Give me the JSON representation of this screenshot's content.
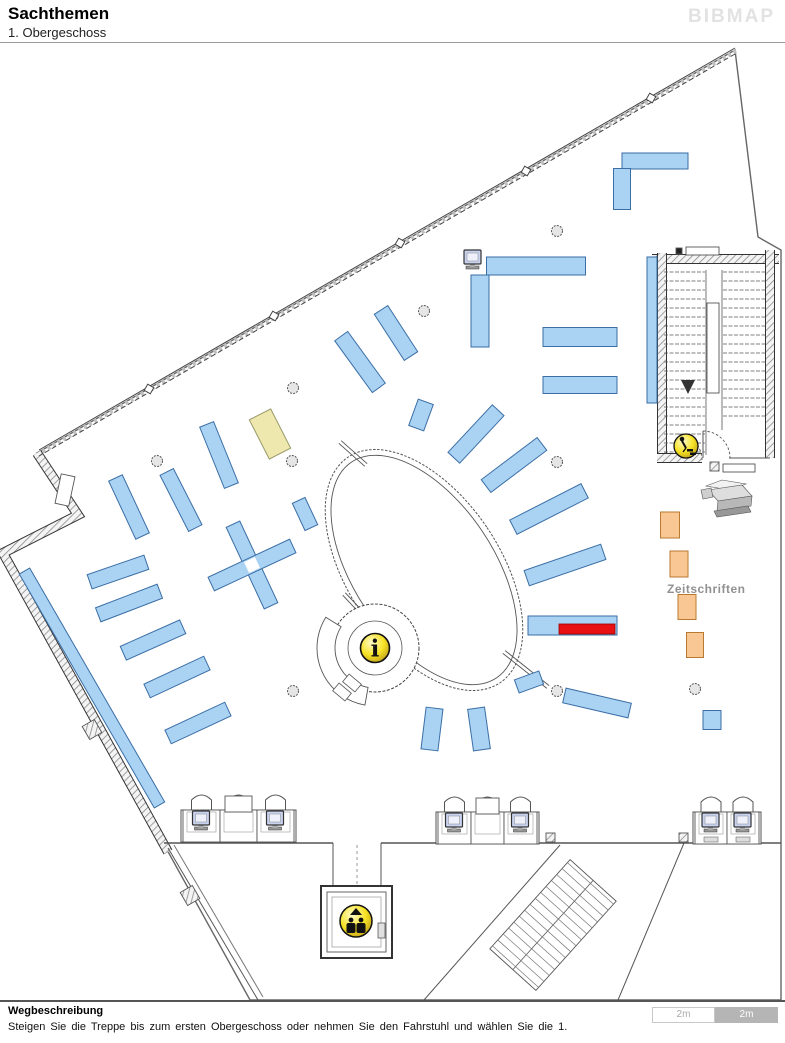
{
  "header": {
    "title": "Sachthemen",
    "subtitle": "1. Obergeschoss",
    "logo": "BIBMAP"
  },
  "footer": {
    "heading": "Wegbeschreibung",
    "text": "Steigen Sie die Treppe bis zum ersten Obergeschoss oder nehmen Sie den Fahrstuhl und wählen Sie die 1.",
    "scale_left": "2m",
    "scale_right": "2m"
  },
  "map": {
    "colors": {
      "shelf_fill": "#a9d2f3",
      "shelf_stroke": "#3a6ea5",
      "yellow_fill": "#eee8ae",
      "yellow_stroke": "#99996a",
      "orange_fill": "#f9c793",
      "orange_stroke": "#b97931",
      "red_fill": "#e81010",
      "red_stroke": "#990000",
      "wall": "#555",
      "column_fill": "#e6e6e6",
      "monitor_fill": "#c9d2ef"
    },
    "labels": [
      {
        "text": "Zeitschriften",
        "x": 667,
        "y": 593,
        "size": 12,
        "color": "#919191"
      }
    ],
    "outline": [
      [
        735,
        50
      ],
      [
        37,
        453
      ],
      [
        78,
        515
      ],
      [
        3,
        553
      ],
      [
        250,
        1000
      ],
      [
        781,
        1000
      ],
      [
        781,
        250
      ],
      [
        758,
        237
      ]
    ],
    "hatch_walls": [
      [
        [
          37,
          453
        ],
        [
          78,
          515
        ],
        [
          3,
          553
        ],
        [
          168,
          852
        ]
      ],
      [
        [
          652,
          259
        ],
        [
          779,
          259
        ]
      ],
      [
        [
          662,
          253
        ],
        [
          662,
          462
        ]
      ],
      [
        [
          770,
          250
        ],
        [
          770,
          458
        ]
      ],
      [
        [
          657,
          458
        ],
        [
          702,
          458
        ]
      ]
    ],
    "nw_wall": {
      "a": [
        735,
        48
      ],
      "b": [
        39,
        450
      ],
      "ticks": [
        [
          651,
          98
        ],
        [
          526,
          171
        ],
        [
          400,
          243
        ],
        [
          274,
          316
        ],
        [
          149,
          389
        ]
      ]
    },
    "lines": [
      [
        164,
        843,
        333,
        843,
        1.5,
        "#555",
        ""
      ],
      [
        381,
        843,
        781,
        843,
        1.5,
        "#555",
        ""
      ],
      [
        333,
        843,
        333,
        887,
        1,
        "#555",
        ""
      ],
      [
        381,
        843,
        381,
        887,
        1,
        "#555",
        ""
      ],
      [
        357,
        845,
        357,
        885,
        1,
        "#999",
        "3 3"
      ],
      [
        560,
        845,
        424,
        1000,
        1,
        "#555",
        ""
      ],
      [
        684,
        843,
        618,
        1000,
        1,
        "#555",
        ""
      ],
      [
        168,
        848,
        258,
        1000,
        1,
        "#555",
        ""
      ],
      [
        174,
        845,
        263,
        997,
        1,
        "#777",
        ""
      ],
      [
        706,
        270,
        706,
        455,
        0.8,
        "#555",
        ""
      ],
      [
        722,
        270,
        722,
        430,
        0.8,
        "#555",
        ""
      ],
      [
        729,
        458,
        770,
        458,
        1,
        "#555",
        ""
      ],
      [
        703,
        431,
        703,
        458,
        1,
        "#555",
        ""
      ]
    ],
    "rects": [
      [
        686,
        247,
        33,
        8,
        "#fff",
        0
      ],
      [
        676,
        248,
        6,
        6,
        "#222",
        0
      ],
      [
        723,
        464,
        32,
        8,
        "#fff",
        0
      ],
      [
        707,
        303,
        12,
        90,
        "#fff",
        0
      ],
      [
        58,
        475,
        14,
        30,
        "#fff",
        12
      ],
      [
        183,
        888,
        14,
        15,
        "hatch",
        -30
      ],
      [
        85,
        722,
        14,
        15,
        "hatch",
        -30
      ],
      [
        710,
        462,
        9,
        9,
        "hatch",
        0
      ],
      [
        284,
        833,
        9,
        9,
        "hatch",
        0
      ],
      [
        546,
        833,
        9,
        9,
        "hatch",
        0
      ],
      [
        679,
        833,
        9,
        9,
        "hatch",
        0
      ]
    ],
    "stair_treads": {
      "left": {
        "x1": 664,
        "x2": 705,
        "y0": 272,
        "y1": 452
      },
      "right": {
        "x1": 723,
        "x2": 765,
        "y0": 272,
        "y1": 420
      },
      "step": 9
    },
    "stair_arrow": [
      [
        681,
        380
      ],
      [
        695,
        380
      ],
      [
        688,
        394
      ]
    ],
    "door_arcs": [
      {
        "path": "M 703,431 A 27 27 0 0 1 730,458"
      },
      {
        "path": "M 702,460 A 26 26 0 0 0 676,434"
      }
    ],
    "diag_stairs": {
      "cx": 553,
      "cy": 925,
      "w": 120,
      "h": 62,
      "r": -48,
      "treads": 15
    },
    "ellipse": {
      "cx": 424,
      "cy": 570,
      "rx": 76,
      "ry": 136,
      "rot": -34
    },
    "connectors": [
      [
        340,
        442,
        366,
        465
      ],
      [
        344,
        594,
        360,
        611
      ],
      [
        504,
        652,
        548,
        687
      ]
    ],
    "info_desk": {
      "cx": 375,
      "cy": 648,
      "r_outer": 44,
      "r_inner": 27,
      "crescent": {
        "r1": 40,
        "r2": 58,
        "a1": 100,
        "a2": 212
      },
      "rects": [
        [
          352,
          683,
          16,
          10,
          40
        ],
        [
          342,
          692,
          16,
          10,
          40
        ]
      ]
    },
    "elevator": {
      "x": 321,
      "y": 886,
      "size": 71,
      "icon": {
        "cx": 356,
        "cy": 921,
        "r": 16
      }
    },
    "icons": {
      "info": {
        "cx": 375,
        "cy": 648,
        "r": 14.5,
        "glyph": "i"
      },
      "stairs_person": {
        "cx": 686,
        "cy": 446,
        "r": 12
      }
    },
    "columns": [
      [
        557,
        231
      ],
      [
        424,
        311
      ],
      [
        293,
        388
      ],
      [
        157,
        461
      ],
      [
        292,
        461
      ],
      [
        557,
        462
      ],
      [
        293,
        691
      ],
      [
        557,
        691
      ],
      [
        695,
        689
      ]
    ],
    "shelves_blue": [
      [
        655,
        161,
        66,
        16,
        0
      ],
      [
        622,
        189,
        17,
        41,
        0
      ],
      [
        536,
        266,
        99,
        18,
        0
      ],
      [
        480,
        311,
        18,
        72,
        0
      ],
      [
        652,
        330,
        10,
        146,
        0
      ],
      [
        580,
        337,
        74,
        19,
        0
      ],
      [
        580,
        385,
        74,
        17,
        0
      ],
      [
        360,
        362,
        16,
        64,
        -36
      ],
      [
        396,
        333,
        16,
        55,
        -33
      ],
      [
        421,
        415,
        16,
        28,
        20
      ],
      [
        476,
        434,
        16,
        65,
        43
      ],
      [
        514,
        465,
        70,
        16,
        -37
      ],
      [
        549,
        509,
        80,
        16,
        -27
      ],
      [
        565,
        565,
        81,
        16,
        -19
      ],
      [
        129,
        507,
        15,
        64,
        -25
      ],
      [
        181,
        500,
        15,
        63,
        -27
      ],
      [
        219,
        455,
        15,
        66,
        -22
      ],
      [
        252,
        565,
        15,
        90,
        -25
      ],
      [
        252,
        565,
        90,
        15,
        -25
      ],
      [
        118,
        572,
        60,
        15,
        -19
      ],
      [
        129,
        603,
        66,
        15,
        -21
      ],
      [
        153,
        640,
        65,
        15,
        -24
      ],
      [
        177,
        677,
        66,
        15,
        -25
      ],
      [
        198,
        723,
        66,
        15,
        -25
      ],
      [
        92,
        688,
        12,
        270,
        -30
      ],
      [
        432,
        729,
        17,
        42,
        7
      ],
      [
        479,
        729,
        17,
        42,
        -8
      ],
      [
        529,
        682,
        26,
        14,
        -20
      ],
      [
        597,
        703,
        67,
        15,
        13
      ],
      [
        712,
        720,
        18,
        19,
        0
      ],
      [
        305,
        514,
        14,
        30,
        -25
      ]
    ],
    "cross_hole": [
      252,
      565,
      12,
      12,
      -25
    ],
    "shelf_yellow": [
      270,
      434,
      24,
      44,
      -27
    ],
    "shelves_orange": [
      [
        670,
        525,
        19,
        26
      ],
      [
        679,
        564,
        18,
        26
      ],
      [
        687,
        607,
        18,
        25
      ],
      [
        695,
        645,
        17,
        25
      ]
    ],
    "highlight": {
      "blue": [
        528,
        616,
        89,
        19
      ],
      "red": [
        559,
        624,
        56,
        10
      ]
    },
    "desk_groups": [
      {
        "x": 183,
        "y": 810,
        "dw": 37,
        "desks": [
          {
            "m": 1
          },
          {
            "box": 1
          },
          {
            "m": 1
          }
        ]
      },
      {
        "x": 438,
        "y": 812,
        "dw": 33,
        "desks": [
          {
            "m": 1
          },
          {
            "box": 1
          },
          {
            "m": 1
          }
        ]
      },
      {
        "x": 695,
        "y": 812,
        "dw": 32,
        "desks": [
          {
            "m": 1,
            "kb": 1
          },
          {
            "m": 1,
            "kb": 1
          }
        ]
      }
    ],
    "single_monitor": [
      464,
      250
    ],
    "printer": [
      {
        "pts": [
          [
            706,
            486
          ],
          [
            722,
            480
          ],
          [
            746,
            484
          ],
          [
            730,
            490
          ]
        ],
        "f": "#f2f2f2"
      },
      {
        "pts": [
          [
            708,
            490
          ],
          [
            742,
            485
          ],
          [
            752,
            496
          ],
          [
            718,
            501
          ]
        ],
        "f": "#dedede"
      },
      {
        "pts": [
          [
            718,
            501
          ],
          [
            752,
            496
          ],
          [
            751,
            506
          ],
          [
            717,
            511
          ]
        ],
        "f": "#b8b8b8"
      },
      {
        "pts": [
          [
            701,
            490
          ],
          [
            711,
            488
          ],
          [
            713,
            497
          ],
          [
            703,
            499
          ]
        ],
        "f": "#cfcfcf"
      },
      {
        "pts": [
          [
            714,
            511
          ],
          [
            748,
            506
          ],
          [
            751,
            512
          ],
          [
            717,
            517
          ]
        ],
        "f": "#989898"
      }
    ]
  }
}
